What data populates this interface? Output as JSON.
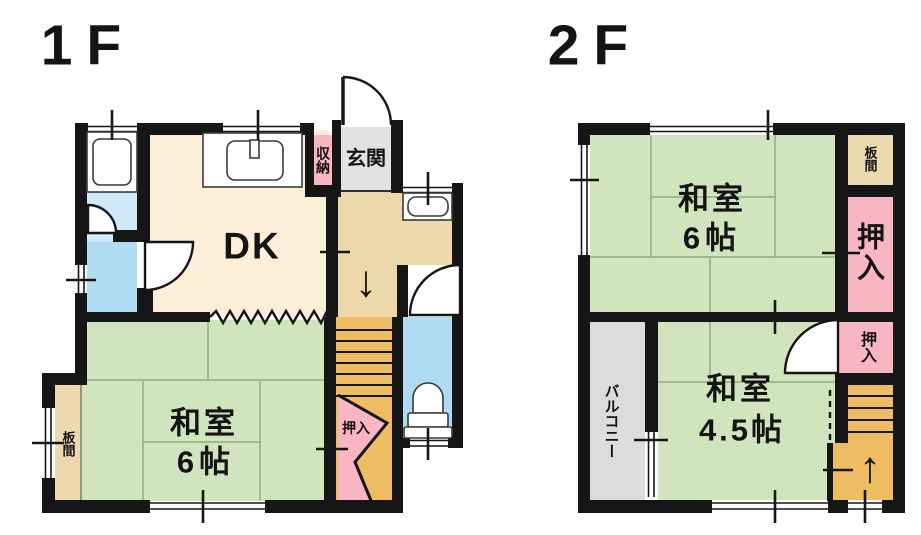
{
  "page": {
    "background": "#ffffff"
  },
  "palette": {
    "wall": "#161616",
    "tatami_green": "#d0e4bd",
    "tatami_line": "#9ab58a",
    "dk_cream": "#fdeed7",
    "hall_tan": "#ecd8a9",
    "stairs_orange": "#eebc63",
    "closet_pink": "#f7b6c2",
    "water_blue": "#afdcf2",
    "washroom_blue": "#cfe9f6",
    "genkan_gray": "#e2e2e2",
    "balcony_gray": "#dcdcdc",
    "itanoma_beige": "#ecd9ae"
  },
  "floor1": {
    "title": "1F",
    "rooms": {
      "dk": "DK",
      "genkan": "玄関",
      "shunou": "収納",
      "washitsu_name": "和室",
      "washitsu_size": "6帖",
      "itanoma": "板間",
      "oshiire": "押入"
    },
    "icons": {
      "stairs_down": "↓"
    }
  },
  "floor2": {
    "title": "2F",
    "rooms": {
      "washitsu6_name": "和室",
      "washitsu6_size": "6帖",
      "itanoma": "板間",
      "oshiire_upper": "押入",
      "oshiire_lower": "押入",
      "washitsu45_name": "和室",
      "washitsu45_size": "4.5帖",
      "balcony": "バルコニー"
    },
    "icons": {
      "stairs_up": "↑"
    }
  }
}
